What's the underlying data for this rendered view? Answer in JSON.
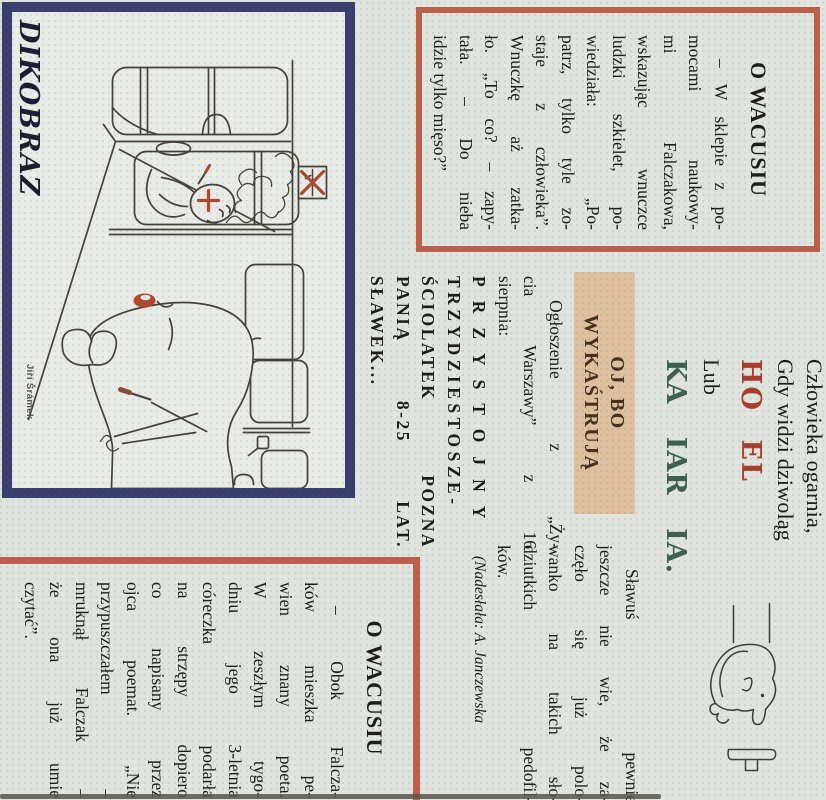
{
  "colors": {
    "page_bg": "#e0e4df",
    "red_border": "#bd5f4a",
    "navy_border": "#3a3e6d",
    "red_word": "#a83d2b",
    "green_word": "#3e614f",
    "tan_highlight": "#dec09f",
    "ink": "#1d1c1a",
    "cartoon_red": "#b0482e"
  },
  "article1": {
    "title": "O WACUSIU",
    "lines": [
      "– W sklepie z po-",
      "mocami naukowy-",
      "mi Falczakowa,",
      "wskazując wnuczce",
      "ludzki szkielet, po-",
      "wiedziała: „Po-",
      "patrz, tylko tyle zo-",
      "staje z człowieka”.",
      "Wnuczkę aż zatka-",
      "ło. „To co? – zapy-",
      "tała. – Do nieba",
      "idzie tylko mięso?”"
    ]
  },
  "riddle": {
    "line1": "Człowieka ogarnia,",
    "line2": "Gdy widzi dziwoląg",
    "red_word": "HO EL",
    "lub": "Lub",
    "green_word": "KA IAR IA."
  },
  "slawus": {
    "lines": [
      "Sławuś pewnie",
      "jeszcze nie wie, że za-",
      "częło się już polo-",
      "wanko na takich sło-",
      "dziutkich pedofil-",
      "ków."
    ]
  },
  "credit": "(Nadesłała: A. Janczewska",
  "ad": {
    "heading1": "OJ, BO",
    "heading2": "WYKAŚTRUJĄ",
    "lines": [
      "Ogłoszenie z „Ży-",
      "cia Warszawy” z 16",
      "sierpnia:",
      "PRZYSTOJNY",
      "TRZYDZIESTOSZE-",
      "ŚCIOLATEK POZNA",
      "PANIĄ 8-25 LAT.",
      "SŁAWEK..."
    ]
  },
  "cartoon": {
    "masthead": "DIKOBRAZ",
    "signature": "Jiří Šrámek"
  },
  "article2": {
    "title": "O WACUSIU",
    "lines": [
      "– Obok Falcza-",
      "ków mieszka pe-",
      "wien znany poeta.",
      "W zeszłym tygo-",
      "dniu jego 3-letnia",
      "córeczka podarła",
      "na strzępy dopiero",
      "co napisany przez",
      "ojca poemat. „Nie",
      "przypuszczałem –",
      "mruknął Falczak –",
      "że ona już umie",
      "czytać”."
    ]
  }
}
